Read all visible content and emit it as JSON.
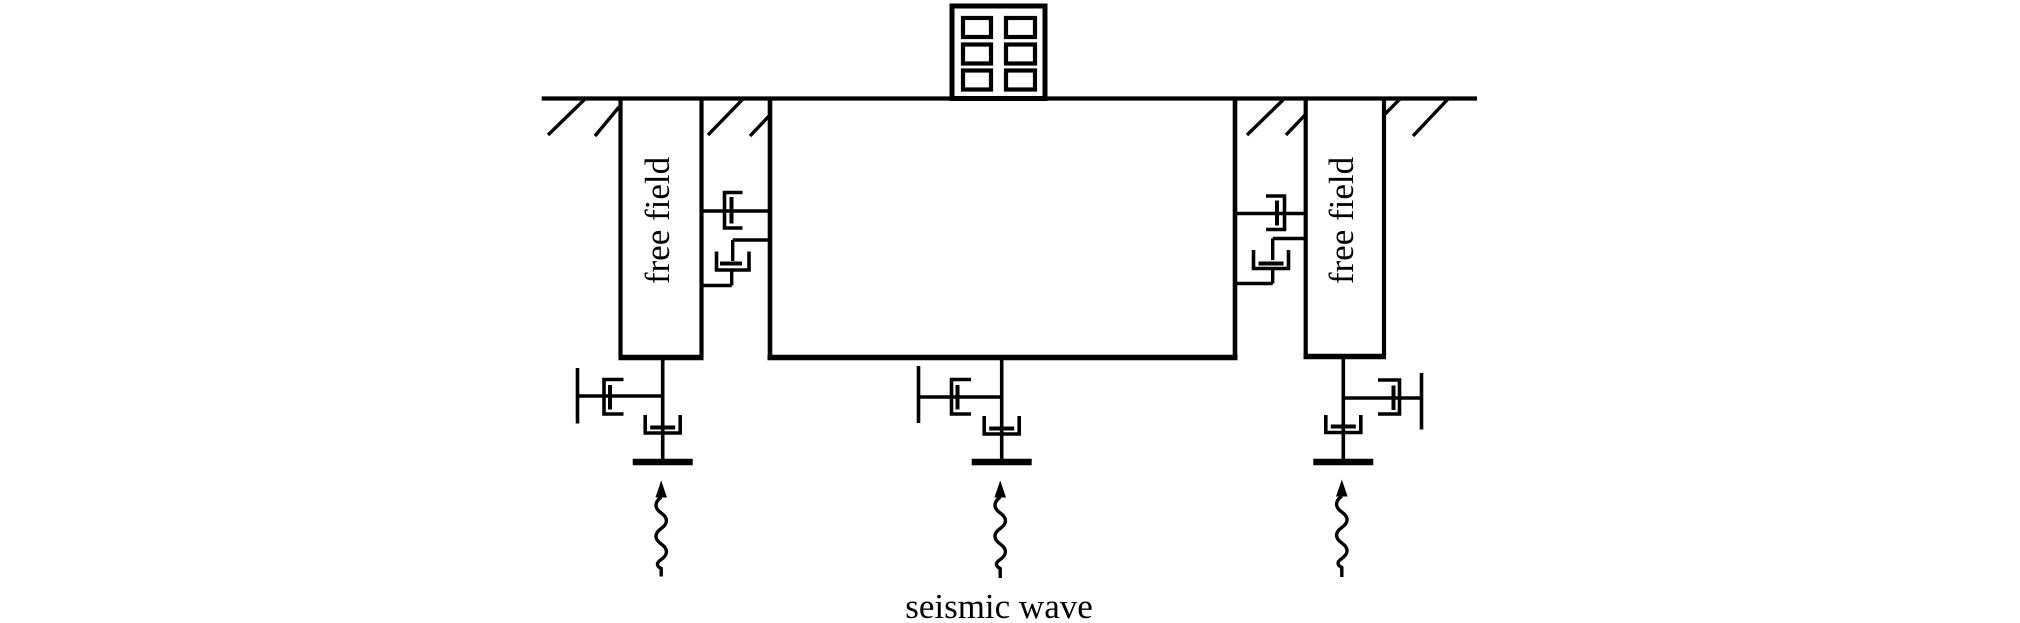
{
  "canvas": {
    "width": 2020,
    "height": 623,
    "background": "#ffffff",
    "ink": "#000000"
  },
  "figure": {
    "type": "engineering-schematic",
    "subject": "soil-structure interaction model: soil block with building, free-field columns, interface dashpots, base supports and seismic wave input"
  },
  "labels": {
    "free_field_left": "free field",
    "free_field_right": "free field",
    "seismic_wave": "seismic wave"
  },
  "elements": {
    "building": {
      "window_rows": 3,
      "window_columns": 2
    },
    "ground_surface": {
      "hatch_marks": 8
    },
    "interface_dashpots": {
      "per_side": 2
    },
    "base_supports": {
      "count": 3,
      "parts": [
        "anchor bar",
        "horizontal dashpot",
        "vertical dashpot",
        "base bar"
      ]
    },
    "seismic_arrows": {
      "count": 3,
      "style": "wavy vertical arrow pointing up"
    }
  }
}
